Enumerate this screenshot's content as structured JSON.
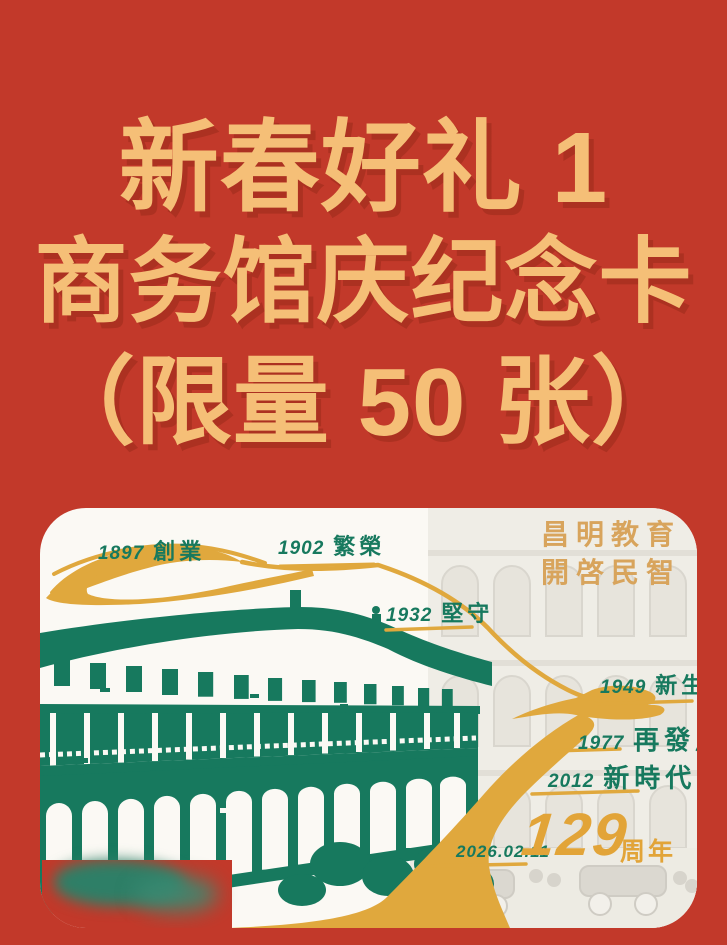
{
  "poster": {
    "background_color": "#c2392a",
    "title": {
      "color": "#f5bf77",
      "line1": "新春好礼 1",
      "line2": "商务馆庆纪念卡",
      "line3": "（限量 50 张）"
    }
  },
  "card": {
    "background_color": "#fbf9f4",
    "slogan": {
      "line1": "昌明教育",
      "line2": "開啓民智",
      "color": "#d8a45c"
    },
    "palette": {
      "green": "#17795e",
      "road_gold": "#e0a83d",
      "faded_gray": "#e9e6df"
    },
    "timeline": [
      {
        "year": "1897",
        "label": "創業"
      },
      {
        "year": "1902",
        "label": "繁榮"
      },
      {
        "year": "1932",
        "label": "堅守"
      },
      {
        "year": "1949",
        "label": "新生"
      },
      {
        "year": "1977",
        "label": "再發展"
      },
      {
        "year": "2012",
        "label": "新時代"
      }
    ],
    "anniversary": {
      "date": "2026.02.11",
      "number": "129",
      "unit": "周年"
    }
  }
}
